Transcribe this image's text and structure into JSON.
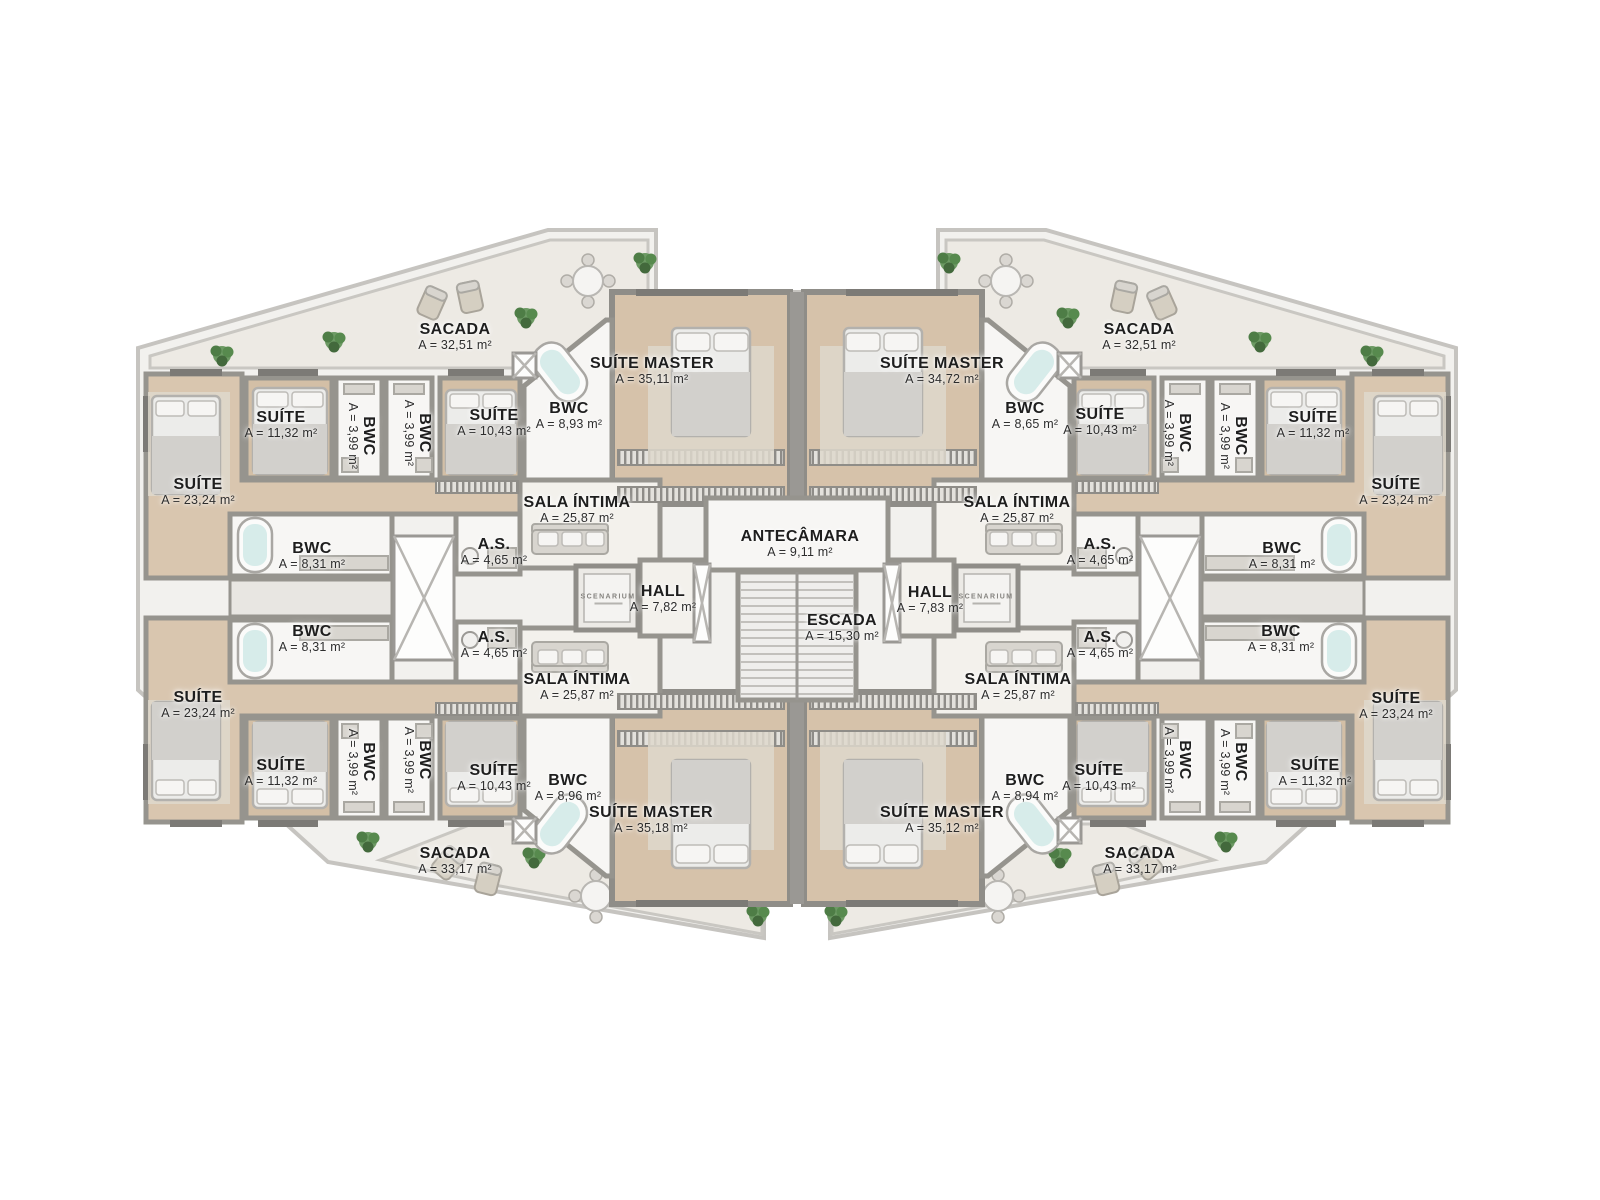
{
  "branding": {
    "logo_text": "SCENARIUM"
  },
  "center": {
    "antecamara": {
      "name": "ANTECÂMARA",
      "area": "A = 9,11 m²"
    },
    "hall_left": {
      "name": "HALL",
      "area": "A = 7,82 m²"
    },
    "hall_right": {
      "name": "HALL",
      "area": "A = 7,83 m²"
    },
    "escada": {
      "name": "ESCADA",
      "area": "A = 15,30 m²"
    }
  },
  "units": {
    "top_left": {
      "sacada": {
        "name": "SACADA",
        "area": "A = 32,51 m²"
      },
      "suite_master": {
        "name": "SUÍTE MASTER",
        "area": "A = 35,11 m²"
      },
      "bwc_master": {
        "name": "BWC",
        "area": "A = 8,93 m²"
      },
      "suite_small": {
        "name": "SUÍTE",
        "area": "A = 10,43 m²"
      },
      "bwc_a": {
        "name": "BWC",
        "area": "A = 3,99 m²"
      },
      "bwc_b": {
        "name": "BWC",
        "area": "A = 3,99 m²"
      },
      "suite_mid": {
        "name": "SUÍTE",
        "area": "A = 11,32 m²"
      },
      "suite_large": {
        "name": "SUÍTE",
        "area": "A = 23,24 m²"
      },
      "sala_intima": {
        "name": "SALA ÍNTIMA",
        "area": "A = 25,87 m²"
      },
      "servico": {
        "name": "A.S.",
        "area": "A = 4,65 m²"
      },
      "bwc_suite": {
        "name": "BWC",
        "area": "A = 8,31 m²"
      }
    },
    "top_right": {
      "sacada": {
        "name": "SACADA",
        "area": "A = 32,51 m²"
      },
      "suite_master": {
        "name": "SUÍTE MASTER",
        "area": "A = 34,72 m²"
      },
      "bwc_master": {
        "name": "BWC",
        "area": "A = 8,65 m²"
      },
      "suite_small": {
        "name": "SUÍTE",
        "area": "A = 10,43 m²"
      },
      "bwc_a": {
        "name": "BWC",
        "area": "A = 3,99 m²"
      },
      "bwc_b": {
        "name": "BWC",
        "area": "A = 3,99 m²"
      },
      "suite_mid": {
        "name": "SUÍTE",
        "area": "A = 11,32 m²"
      },
      "suite_large": {
        "name": "SUÍTE",
        "area": "A = 23,24 m²"
      },
      "sala_intima": {
        "name": "SALA ÍNTIMA",
        "area": "A = 25,87 m²"
      },
      "servico": {
        "name": "A.S.",
        "area": "A = 4,65 m²"
      },
      "bwc_suite": {
        "name": "BWC",
        "area": "A = 8,31 m²"
      }
    },
    "bottom_left": {
      "sacada": {
        "name": "SACADA",
        "area": "A = 33,17 m²"
      },
      "suite_master": {
        "name": "SUÍTE MASTER",
        "area": "A = 35,18 m²"
      },
      "bwc_master": {
        "name": "BWC",
        "area": "A = 8,96 m²"
      },
      "suite_small": {
        "name": "SUÍTE",
        "area": "A = 10,43 m²"
      },
      "bwc_a": {
        "name": "BWC",
        "area": "A = 3,99 m²"
      },
      "bwc_b": {
        "name": "BWC",
        "area": "A = 3,99 m²"
      },
      "suite_mid": {
        "name": "SUÍTE",
        "area": "A = 11,32 m²"
      },
      "suite_large": {
        "name": "SUÍTE",
        "area": "A = 23,24 m²"
      },
      "sala_intima": {
        "name": "SALA ÍNTIMA",
        "area": "A = 25,87 m²"
      },
      "servico": {
        "name": "A.S.",
        "area": "A = 4,65 m²"
      },
      "bwc_suite": {
        "name": "BWC",
        "area": "A = 8,31 m²"
      }
    },
    "bottom_right": {
      "sacada": {
        "name": "SACADA",
        "area": "A = 33,17 m²"
      },
      "suite_master": {
        "name": "SUÍTE MASTER",
        "area": "A = 35,12 m²"
      },
      "bwc_master": {
        "name": "BWC",
        "area": "A = 8,94 m²"
      },
      "suite_small": {
        "name": "SUÍTE",
        "area": "A = 10,43 m²"
      },
      "bwc_a": {
        "name": "BWC",
        "area": "A = 3,99 m²"
      },
      "bwc_b": {
        "name": "BWC",
        "area": "A = 3,99 m²"
      },
      "suite_mid": {
        "name": "SUÍTE",
        "area": "A = 11,32 m²"
      },
      "suite_large": {
        "name": "SUÍTE",
        "area": "A = 23,24 m²"
      },
      "sala_intima": {
        "name": "SALA ÍNTIMA",
        "area": "A = 25,87 m²"
      },
      "servico": {
        "name": "A.S.",
        "area": "A = 4,65 m²"
      },
      "bwc_suite": {
        "name": "BWC",
        "area": "A = 8,31 m²"
      }
    }
  }
}
